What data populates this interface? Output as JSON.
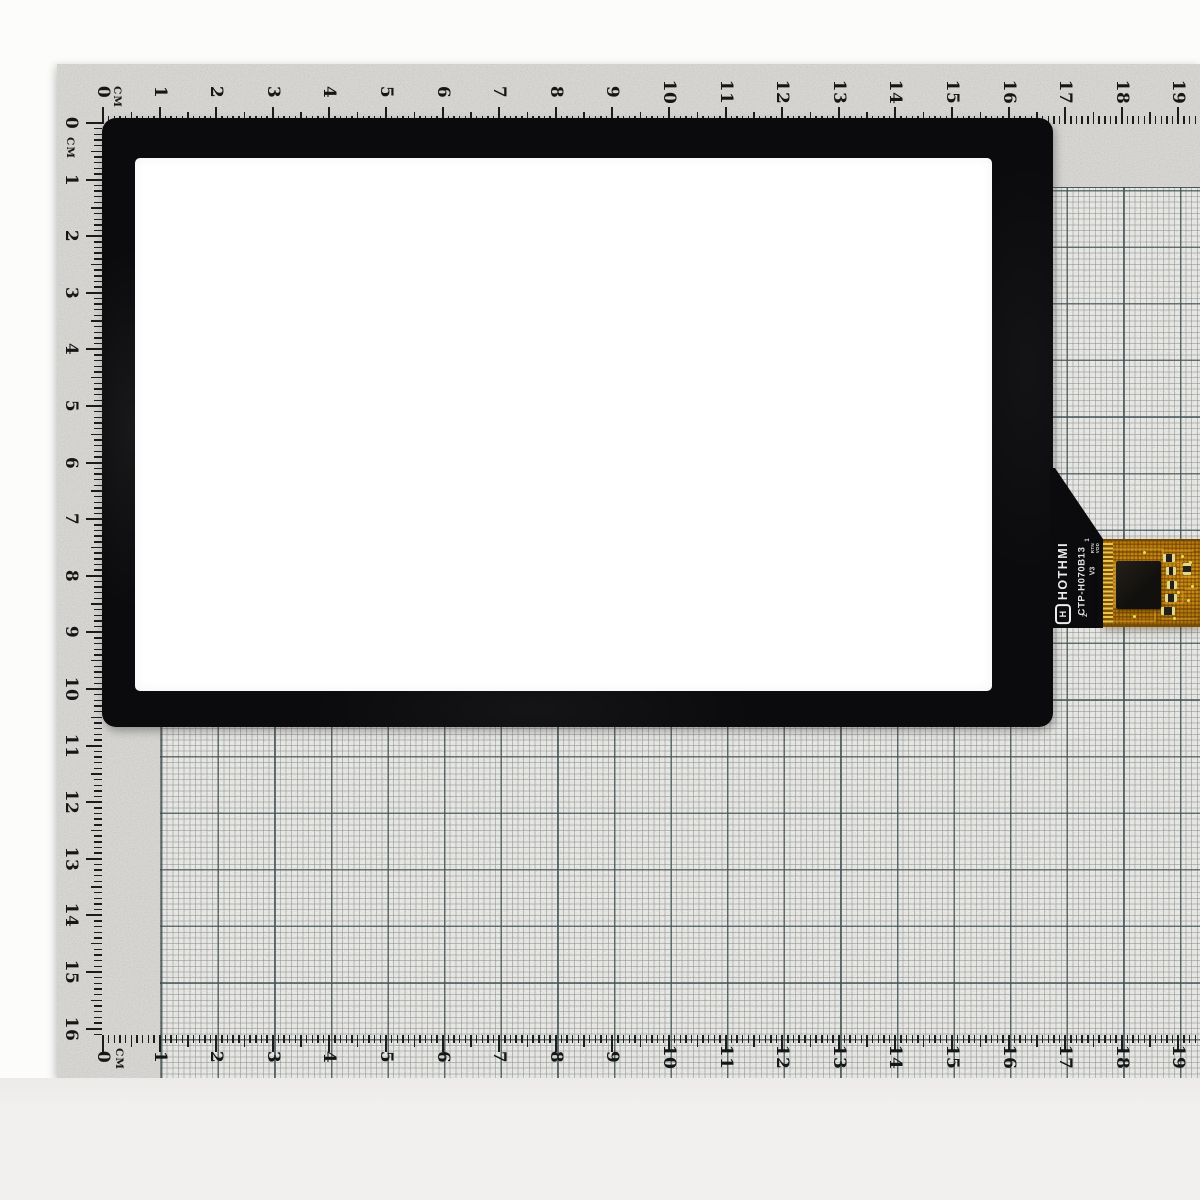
{
  "scene": {
    "description": "Capacitive touch panel glass photographed on a centimeter grid cutting mat"
  },
  "ruler": {
    "unit": "CM",
    "top_numbers": [
      "0",
      "1",
      "2",
      "3",
      "4",
      "5",
      "6",
      "7",
      "8",
      "9",
      "10",
      "11",
      "12",
      "13",
      "14",
      "15",
      "16",
      "17",
      "18",
      "19"
    ],
    "bottom_numbers": [
      "0",
      "1",
      "2",
      "3",
      "4",
      "5",
      "6",
      "7",
      "8",
      "9",
      "10",
      "11",
      "12",
      "13",
      "14",
      "15",
      "16",
      "17",
      "18",
      "19"
    ],
    "left_numbers": [
      "0",
      "1",
      "2",
      "3",
      "4",
      "5",
      "6",
      "7",
      "8",
      "9",
      "10",
      "11",
      "12",
      "13",
      "14",
      "15",
      "16"
    ]
  },
  "panel": {
    "brand": "HOTHMI",
    "logo_letter": "H",
    "model": "CTP-H070B13",
    "mark": "Z",
    "revision": "V3",
    "pin_first": "1",
    "pin_labels": [
      "RTN",
      "VDD"
    ]
  },
  "colors": {
    "bezel": "#0b0b0d",
    "active_area": "#ffffff",
    "fpc_orange": "#c8860f",
    "paper": "#d8d7d4",
    "grid_line": "#3c4e52",
    "photo_background": "#fcfcfb"
  }
}
